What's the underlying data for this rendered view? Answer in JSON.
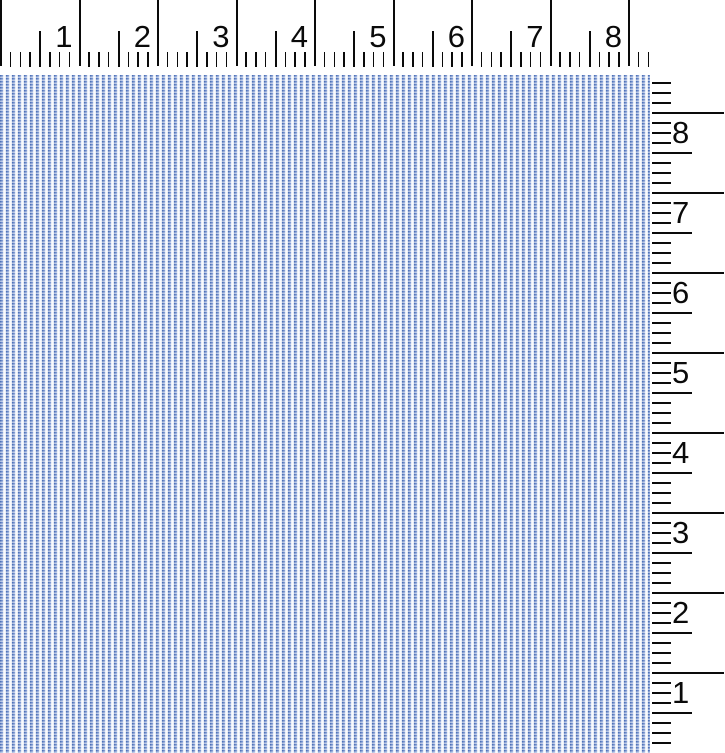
{
  "scene": {
    "kind": "fabric-swatch-photo-with-rulers",
    "background": "#ffffff"
  },
  "fabric": {
    "pattern": "fine blue and white vertical pinstripe weave",
    "colors": {
      "stripe_dark": "#4f72b8",
      "stripe_mid": "#7f9ad2",
      "stripe_pale": "#e3e9f5",
      "ground_white": "#f7f9fd",
      "weave_highlight": "rgba(255,255,255,0.55)"
    }
  },
  "rulers": {
    "unit": "inches",
    "divisions_per_inch": 8,
    "tick_color": "#0a0a0a",
    "top": {
      "numbers": [
        "1",
        "2",
        "3",
        "4",
        "5",
        "6",
        "7",
        "8"
      ],
      "inch_px": 78.5,
      "length_px": 652
    },
    "right": {
      "numbers": [
        "8",
        "7",
        "6",
        "5",
        "4",
        "3",
        "2",
        "1"
      ],
      "inch_px": 80,
      "first_line_y_px": 112,
      "band_top_px": 75,
      "first_eighth_y_px": 82,
      "last_tick_y_px": 748
    }
  }
}
